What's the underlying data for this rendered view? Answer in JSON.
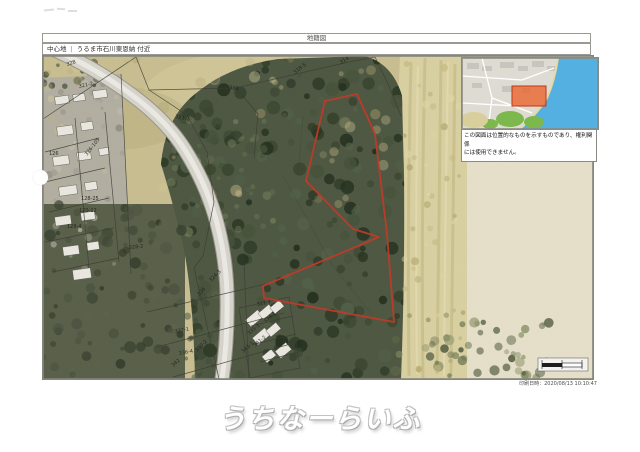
{
  "document": {
    "map_type_title": "地籍図",
    "header": {
      "label": "中心地",
      "separator": "|",
      "address": "うるま市石川東恩納 付近"
    },
    "inset_caption": {
      "line1": "この図面は位置的なものを示すものであり、権利関係",
      "line2": "には使用できません。"
    },
    "print_datetime": "印刷日時：2020/08/13 10:10:47",
    "watermark": "うちなーらいふ"
  },
  "map": {
    "highlight_outline_color": "#c03a28",
    "inset_highlight_color": "#ea6530",
    "inset_sea_color": "#54b0e0",
    "parcel_labels": [
      {
        "text": "328",
        "x": 24,
        "y": 10,
        "r": -18
      },
      {
        "text": "321-2",
        "x": 36,
        "y": 32,
        "r": -12
      },
      {
        "text": "338",
        "x": 186,
        "y": 33,
        "r": 8
      },
      {
        "text": "318-5",
        "x": 252,
        "y": 18,
        "r": -38
      },
      {
        "text": "314",
        "x": 298,
        "y": 8,
        "r": -30
      },
      {
        "text": "321-2",
        "x": 132,
        "y": 62,
        "r": 10
      },
      {
        "text": "326-105",
        "x": 44,
        "y": 100,
        "r": -52
      },
      {
        "text": "126",
        "x": 6,
        "y": 99,
        "r": 0
      },
      {
        "text": "128-25",
        "x": 38,
        "y": 144,
        "r": 0
      },
      {
        "text": "120-12",
        "x": 36,
        "y": 156,
        "r": 0
      },
      {
        "text": "128-4",
        "x": 24,
        "y": 172,
        "r": 0
      },
      {
        "text": "328-2",
        "x": 86,
        "y": 193,
        "r": -6
      },
      {
        "text": "324-3",
        "x": 168,
        "y": 226,
        "r": -45
      },
      {
        "text": "336",
        "x": 156,
        "y": 240,
        "r": -45
      },
      {
        "text": "321-1",
        "x": 214,
        "y": 250,
        "r": -12
      },
      {
        "text": "337-1",
        "x": 132,
        "y": 277,
        "r": -10
      },
      {
        "text": "336-4",
        "x": 136,
        "y": 299,
        "r": -10
      },
      {
        "text": "330-2",
        "x": 154,
        "y": 296,
        "r": -45
      },
      {
        "text": "342",
        "x": 130,
        "y": 311,
        "r": -40
      },
      {
        "text": "334-1",
        "x": 222,
        "y": 267,
        "r": -40
      },
      {
        "text": "335-1",
        "x": 206,
        "y": 279,
        "r": -40
      },
      {
        "text": "341-2",
        "x": 212,
        "y": 291,
        "r": -40
      },
      {
        "text": "343-1",
        "x": 200,
        "y": 297,
        "r": -40
      }
    ]
  }
}
